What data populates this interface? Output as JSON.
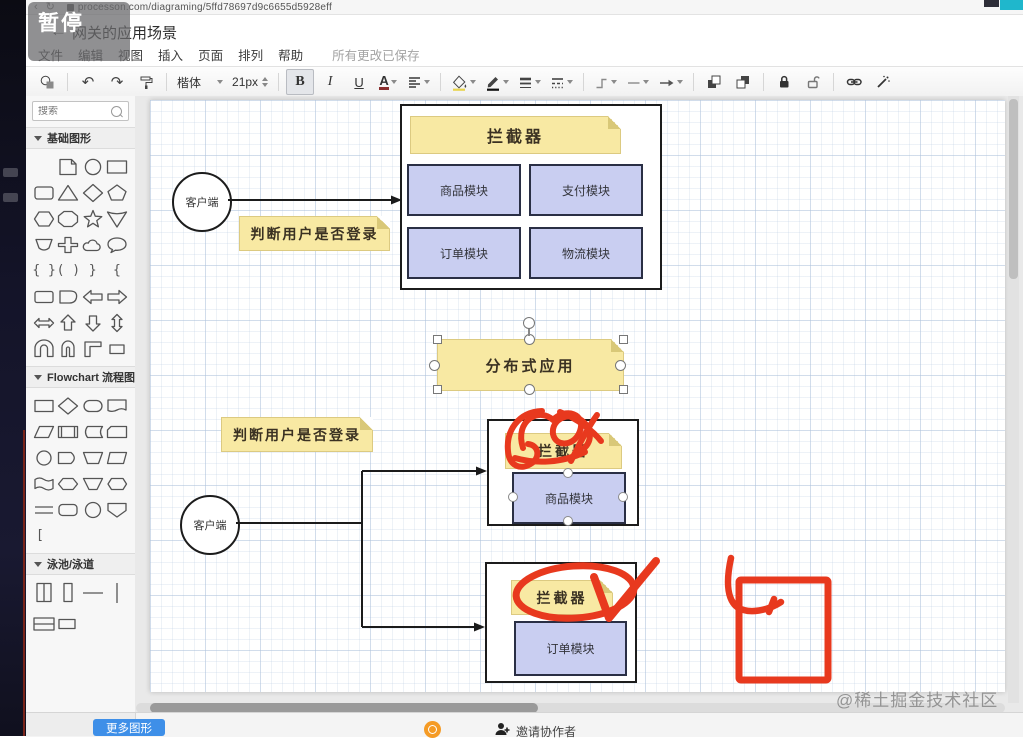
{
  "browser": {
    "url": "processon.com/diagraming/5ffd78697d9c6655d5928eff",
    "back_glyph": "‹",
    "reload_glyph": "↻"
  },
  "overlay": {
    "pause_label": "暂停"
  },
  "header": {
    "back_glyph": "←",
    "title": "网关的应用场景",
    "menus": [
      "文件",
      "编辑",
      "视图",
      "插入",
      "页面",
      "排列",
      "帮助"
    ],
    "save_status": "所有更改已保存"
  },
  "toolbar": {
    "undo_glyph": "↶",
    "redo_glyph": "↷",
    "font_name": "楷体",
    "font_size": "21px",
    "bold_label": "B",
    "italic_label": "I",
    "underline_label": "U",
    "font_color_label": "A"
  },
  "sidebar": {
    "search_placeholder": "搜索",
    "text_tool_glyph": "T",
    "sections": [
      {
        "title": "基础图形",
        "shapes": [
          "text",
          "sticky-note",
          "ellipse",
          "rectangle",
          "rounded-rectangle",
          "triangle",
          "diamond",
          "pentagon",
          "hexagon",
          "octagon",
          "star",
          "cone",
          "chord",
          "cross",
          "cloud",
          "callout",
          "brace-pair",
          "paren-pair",
          "brace-right",
          "brace-left",
          "rounded-rect",
          "blob",
          "arrow-left",
          "arrow-right",
          "arrow-left-right",
          "arrow-up",
          "arrow-down",
          "arrow-up-down",
          "u-shape",
          "u-shape-narrow",
          "corner",
          "small-rectangle"
        ]
      },
      {
        "title": "Flowchart 流程图",
        "shapes": [
          "process",
          "decision",
          "terminator",
          "document",
          "parallelogram",
          "predefined-process",
          "stored-data",
          "card",
          "circle",
          "delay",
          "manual-operation",
          "trapezoid",
          "wavy-document",
          "preparation",
          "inverted-trapezoid",
          "hexagon",
          "double-line",
          "rounded-process",
          "connector-circle",
          "off-page-connector",
          "bracket"
        ]
      },
      {
        "title": "泳池/泳道",
        "shapes": [
          "vertical-pool",
          "vertical-lane",
          "horizontal-line",
          "vertical-line",
          "horizontal-pool",
          "rectangle"
        ]
      }
    ],
    "glyph_items": [
      "{ }",
      "( )",
      "}",
      "{"
    ],
    "flow_bracket": "[",
    "more_shapes_button": "更多图形"
  },
  "footer": {
    "invite_label": "邀请协作者"
  },
  "canvas": {
    "watermark": "@稀土掘金技术社区",
    "scene1": {
      "client": "客户端",
      "decision_note": "判断用户是否登录",
      "interceptor_note": "拦截器",
      "modules": [
        "商品模块",
        "支付模块",
        "订单模块",
        "物流模块"
      ]
    },
    "selected_note": "分布式应用",
    "scene2": {
      "client": "客户端",
      "decision_note": "判断用户是否登录",
      "top": {
        "interceptor_note": "拦截器",
        "module": "商品模块"
      },
      "bottom": {
        "interceptor_note": "拦截器",
        "module": "订单模块"
      }
    }
  },
  "colors": {
    "note_fill": "#F8E9A3",
    "note_fold": "#D9C878",
    "module_fill": "#C9CEF1",
    "module_border": "#2A2F45",
    "red_annotation": "#E8391E",
    "accent_blue": "#3E8FE8",
    "teal_chip": "#1FB7CC"
  }
}
